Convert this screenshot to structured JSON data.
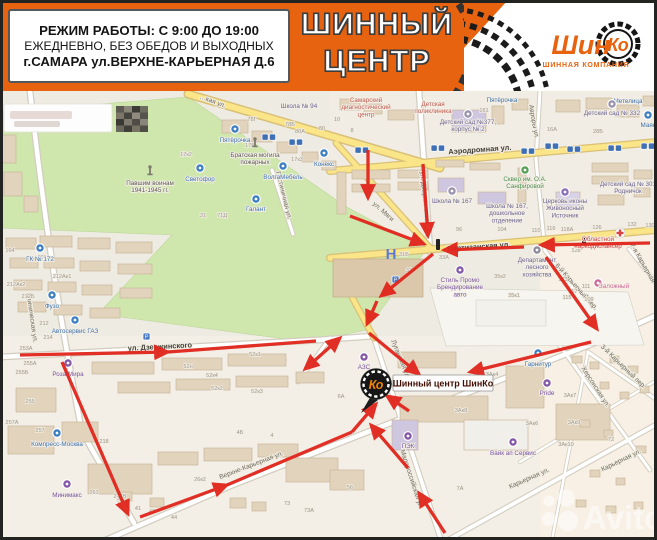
{
  "header": {
    "info": {
      "line1": "РЕЖИМ РАБОТЫ: С 9:00 ДО 19:00",
      "line2": "ЕЖЕДНЕВНО, БЕЗ ОБЕДОВ И ВЫХОДНЫХ",
      "line3": "г.САМАРА ул.ВЕРХНЕ-КАРЬЕРНАЯ Д.6"
    },
    "title_line1": "ШИННЫЙ",
    "title_line2": "ЦЕНТР",
    "logo": {
      "shin": "Шин",
      "ko": "Ко",
      "subtitle": "ШИННАЯ КОМПАНИЯ"
    },
    "colors": {
      "accent_orange": "#e7630f",
      "arrow_red": "#e1251b"
    }
  },
  "watermark": {
    "text": "Avito"
  },
  "map": {
    "marker": {
      "label": "Шинный центр ШинКо",
      "pin": "Ко"
    },
    "street_labels": [
      {
        "t": "…кая ул.",
        "x": 212,
        "y": 103,
        "r": 21
      },
      {
        "t": "Аэродромная ул.",
        "x": 480,
        "y": 152,
        "r": -4,
        "dark": 1
      },
      {
        "t": "ул. Дзержинского",
        "x": 423,
        "y": 198,
        "r": 84
      },
      {
        "t": "Авроры ул.",
        "x": 532,
        "y": 122,
        "r": 80
      },
      {
        "t": "ул. Мяги",
        "x": 382,
        "y": 213,
        "r": 42
      },
      {
        "t": "Партизанская ул.",
        "x": 479,
        "y": 249,
        "r": -4,
        "dark": 1
      },
      {
        "t": "ул. Дзержинского",
        "x": 160,
        "y": 349,
        "r": -3,
        "dark": 1
      },
      {
        "t": "Клиническая ул.",
        "x": 30,
        "y": 318,
        "r": 82
      },
      {
        "t": "Луганская ул.",
        "x": 399,
        "y": 360,
        "r": 68
      },
      {
        "t": "Малороссийская ул.",
        "x": 410,
        "y": 480,
        "r": 72
      },
      {
        "t": "Верхне-Карьерная ул.",
        "x": 252,
        "y": 467,
        "r": -21
      },
      {
        "t": "Карьерная ул.",
        "x": 530,
        "y": 480,
        "r": -24
      },
      {
        "t": "Карьерная ул.",
        "x": 622,
        "y": 462,
        "r": -26
      },
      {
        "t": "6-й Карьерный пер.",
        "x": 575,
        "y": 288,
        "r": 48
      },
      {
        "t": "7-я Карьерная",
        "x": 641,
        "y": 264,
        "r": 60
      },
      {
        "t": "Херсонская ул.",
        "x": 594,
        "y": 388,
        "r": 57
      },
      {
        "t": "3-й Карьерный пер.",
        "x": 622,
        "y": 368,
        "r": 44
      },
      {
        "t": "Гостиничная ул.",
        "x": 282,
        "y": 196,
        "r": 76
      }
    ],
    "poi": [
      {
        "t": "Пятёрочка",
        "x": 235,
        "y": 129,
        "ly": 142,
        "c": "#3b7ec2",
        "lc": "#3f72ae"
      },
      {
        "t": "Светофор",
        "x": 200,
        "y": 168,
        "ly": 181,
        "c": "#3b7ec2",
        "lc": "#3f72ae"
      },
      {
        "t": "ВолгаМебель",
        "x": 283,
        "y": 166,
        "ly": 179,
        "c": "#3b7ec2",
        "lc": "#3f72ae"
      },
      {
        "t": "Галант",
        "x": 256,
        "y": 199,
        "ly": 211,
        "c": "#3b7ec2",
        "lc": "#3f72ae"
      },
      {
        "t": "Конекс",
        "x": 324,
        "y": 153,
        "ly": 166,
        "c": "#3b7ec2",
        "lc": "#3f72ae"
      },
      {
        "t": "Маяк",
        "x": 648,
        "y": 115,
        "ly": 127,
        "c": "#3b7ec2",
        "lc": "#3f72ae"
      },
      {
        "t": "ГК № 172",
        "x": 40,
        "y": 248,
        "ly": 261,
        "c": "#3b7ec2",
        "lc": "#3f72ae"
      },
      {
        "t": "Фузо",
        "x": 52,
        "y": 295,
        "ly": 308,
        "c": "#3b7ec2",
        "lc": "#3f72ae"
      },
      {
        "t": "Автосервис ГАЗ",
        "x": 75,
        "y": 320,
        "ly": 333,
        "c": "#3b7ec2",
        "lc": "#3f72ae"
      },
      {
        "t": "Роза Мира",
        "x": 68,
        "y": 363,
        "ly": 376,
        "c": "#8457a8",
        "lc": "#7a55a0"
      },
      {
        "t": "Компресс-Москва",
        "x": 57,
        "y": 433,
        "ly": 446,
        "c": "#3b7ec2",
        "lc": "#3f72ae"
      },
      {
        "t": "Минимакс",
        "x": 67,
        "y": 484,
        "ly": 497,
        "c": "#8457a8",
        "lc": "#7a55a0"
      },
      {
        "t": "АЗС",
        "x": 364,
        "y": 357,
        "ly": 369,
        "c": "#8457a8",
        "lc": "#7a55a0"
      },
      {
        "t": "ПЭК",
        "x": 408,
        "y": 436,
        "ly": 448,
        "c": "#8457a8",
        "lc": "#7a55a0"
      },
      {
        "t": "Вайк ап Сервис",
        "x": 513,
        "y": 442,
        "ly": 455,
        "c": "#8457a8",
        "lc": "#7a55a0"
      },
      {
        "t": "Pride",
        "x": 547,
        "y": 383,
        "ly": 395,
        "c": "#8457a8",
        "lc": "#7a55a0"
      },
      {
        "t": "Гарнитур",
        "x": 538,
        "y": 353,
        "ly": 366,
        "c": "#3b7ec2",
        "lc": "#3f72ae"
      },
      {
        "t": "Пятёрочка",
        "ic": "none",
        "x": 502,
        "ly": 102,
        "lc": "#3f72ae"
      },
      {
        "t": "Метелица",
        "ic": "none",
        "x": 628,
        "ly": 103,
        "lc": "#3f72ae"
      },
      {
        "t": "Школа № 94",
        "ic": "none",
        "x": 299,
        "ly": 108,
        "lc": "#6b6391"
      },
      {
        "t": "Самарский\nдиагностический\nцентр",
        "ic": "none",
        "x": 366,
        "ly": 102,
        "lc": "#c05a50"
      },
      {
        "t": "Детская\nполиклиника",
        "ic": "none",
        "x": 433,
        "ly": 106,
        "lc": "#c05a50"
      },
      {
        "t": "Детский сад №377,\nкорпус № 2",
        "x": 468,
        "y": 114,
        "ly": 124,
        "c": "#9a93ad",
        "lc": "#6b6391"
      },
      {
        "t": "Детский сад № 332",
        "x": 612,
        "y": 104,
        "ly": 115,
        "c": "#9a93ad",
        "lc": "#6b6391"
      },
      {
        "t": "Детский сад № 301\nРодничок",
        "ic": "none",
        "x": 628,
        "ly": 186,
        "lc": "#6b6391"
      },
      {
        "t": "Школа № 167",
        "x": 452,
        "y": 191,
        "ly": 203,
        "c": "#9a93ad",
        "lc": "#6b6391"
      },
      {
        "t": "Школа № 167,\nдошкольное\nотделение",
        "ic": "none",
        "x": 507,
        "ly": 208,
        "lc": "#6b6391"
      },
      {
        "t": "Сквер им. О.А.\nСанфировой",
        "x": 525,
        "y": 170,
        "ly": 181,
        "c": "#58a058",
        "lc": "#4e8f4e"
      },
      {
        "t": "Церковь иконы\nЖивоносный\nИсточник",
        "x": 565,
        "y": 192,
        "ly": 203,
        "c": "#8a6fb8",
        "lc": "#6b6391"
      },
      {
        "t": "Департамент\nлесного\nхозяйства",
        "x": 537,
        "y": 250,
        "ly": 262,
        "c": "#8a8a9a",
        "lc": "#6b6391"
      },
      {
        "t": "Областной\nнаркодиспансер",
        "ic": "cross",
        "x": 620,
        "y": 233,
        "lx": 598,
        "ly": 241,
        "lc": "#cc4444"
      },
      {
        "t": "Стиль Промо\nБрендирование\nавто",
        "x": 460,
        "y": 270,
        "ly": 282,
        "c": "#8457a8",
        "lc": "#7a55a0"
      },
      {
        "t": "Заложный",
        "x": 598,
        "y": 283,
        "ly": 288,
        "lx": 614,
        "c": "#d06a9a",
        "lc": "#d06a9a"
      },
      {
        "t": "Братская могила\nпожарных",
        "ic": "mon",
        "x": 255,
        "y": 147,
        "ly": 157,
        "lc": "#5a5a52"
      },
      {
        "t": "Павшим воинам\n1941-1945 гг.",
        "ic": "mon",
        "x": 150,
        "y": 175,
        "ly": 185,
        "lc": "#5a5a52"
      }
    ],
    "house_numbers": [
      [
        "78Г",
        252,
        121
      ],
      [
        "78Б",
        290,
        126
      ],
      [
        "80А",
        300,
        133
      ],
      [
        "80",
        322,
        130
      ],
      [
        "10",
        337,
        121
      ],
      [
        "8",
        352,
        132
      ],
      [
        "17к2",
        186,
        156
      ],
      [
        "17Б",
        250,
        147
      ],
      [
        "17к4",
        274,
        157
      ],
      [
        "17к3",
        297,
        161
      ],
      [
        "161",
        484,
        112
      ],
      [
        "16А",
        552,
        131
      ],
      [
        "28Б",
        598,
        133
      ],
      [
        "130",
        650,
        227
      ],
      [
        "132",
        632,
        226
      ],
      [
        "71Д",
        222,
        217
      ],
      [
        "31",
        203,
        217
      ],
      [
        "201",
        42,
        259
      ],
      [
        "164",
        10,
        252
      ],
      [
        "212Ак1",
        62,
        278
      ],
      [
        "212Ак2",
        16,
        286
      ],
      [
        "212Б",
        28,
        298
      ],
      [
        "212",
        44,
        325
      ],
      [
        "214",
        48,
        339
      ],
      [
        "253А",
        26,
        350
      ],
      [
        "255А",
        30,
        365
      ],
      [
        "255Б",
        22,
        374
      ],
      [
        "255",
        30,
        403
      ],
      [
        "52н",
        188,
        368
      ],
      [
        "52к1",
        255,
        356
      ],
      [
        "52к4",
        212,
        377
      ],
      [
        "52к2",
        217,
        390
      ],
      [
        "52к3",
        257,
        393
      ],
      [
        "96",
        459,
        231
      ],
      [
        "104",
        502,
        231
      ],
      [
        "110",
        536,
        232
      ],
      [
        "116",
        551,
        230
      ],
      [
        "118А",
        567,
        231
      ],
      [
        "126",
        597,
        229
      ],
      [
        "128",
        576,
        252
      ],
      [
        "123",
        563,
        281
      ],
      [
        "117",
        573,
        293
      ],
      [
        "115",
        567,
        299
      ],
      [
        "111",
        586,
        288
      ],
      [
        "109",
        589,
        301
      ],
      [
        "31Б",
        404,
        256
      ],
      [
        "33",
        409,
        272
      ],
      [
        "33А",
        444,
        259
      ],
      [
        "35к2",
        500,
        278
      ],
      [
        "35к1",
        514,
        297
      ],
      [
        "6А",
        341,
        398
      ],
      [
        "3Ак4",
        492,
        376
      ],
      [
        "3Ак7",
        570,
        397
      ],
      [
        "3Ак8",
        461,
        412
      ],
      [
        "3Ак6",
        532,
        425
      ],
      [
        "3Ак9",
        574,
        424
      ],
      [
        "3Ак10",
        566,
        446
      ],
      [
        "72",
        611,
        441
      ],
      [
        "73",
        287,
        505
      ],
      [
        "73А",
        309,
        512
      ],
      [
        "7А",
        460,
        490
      ],
      [
        "56",
        350,
        489
      ],
      [
        "257",
        40,
        432
      ],
      [
        "257А",
        12,
        424
      ],
      [
        "218",
        104,
        443
      ],
      [
        "261",
        94,
        494
      ],
      [
        "214В",
        120,
        498
      ],
      [
        "26к2",
        200,
        481
      ],
      [
        "4Б",
        240,
        434
      ],
      [
        "4",
        272,
        437
      ],
      [
        "44",
        174,
        519
      ],
      [
        "43",
        152,
        513
      ],
      [
        "41",
        138,
        510
      ],
      [
        "36",
        120,
        500
      ]
    ],
    "transit_stops": [
      [
        262,
        134
      ],
      [
        289,
        139
      ],
      [
        355,
        147
      ],
      [
        431,
        145
      ],
      [
        521,
        148
      ],
      [
        545,
        143
      ],
      [
        567,
        146
      ],
      [
        608,
        145
      ],
      [
        641,
        143
      ]
    ],
    "parking": [
      [
        143,
        333
      ],
      [
        392,
        276
      ]
    ],
    "route_arrows": [
      [
        368,
        150,
        368,
        198
      ],
      [
        423,
        164,
        428,
        236
      ],
      [
        350,
        216,
        424,
        244
      ],
      [
        650,
        243,
        541,
        245
      ],
      [
        524,
        247,
        444,
        250
      ],
      [
        433,
        254,
        381,
        296
      ],
      [
        377,
        301,
        367,
        324
      ],
      [
        369,
        333,
        419,
        374
      ],
      [
        546,
        257,
        597,
        329
      ],
      [
        591,
        342,
        470,
        372
      ],
      [
        20,
        355,
        168,
        352
      ],
      [
        168,
        352,
        316,
        341,
        "none"
      ],
      [
        305,
        369,
        340,
        338,
        "double"
      ],
      [
        62,
        362,
        128,
        514
      ],
      [
        140,
        517,
        227,
        485
      ],
      [
        227,
        485,
        352,
        432,
        "none"
      ],
      [
        352,
        432,
        376,
        404
      ],
      [
        445,
        533,
        419,
        493
      ],
      [
        408,
        468,
        371,
        425
      ],
      [
        409,
        411,
        387,
        396
      ]
    ]
  }
}
